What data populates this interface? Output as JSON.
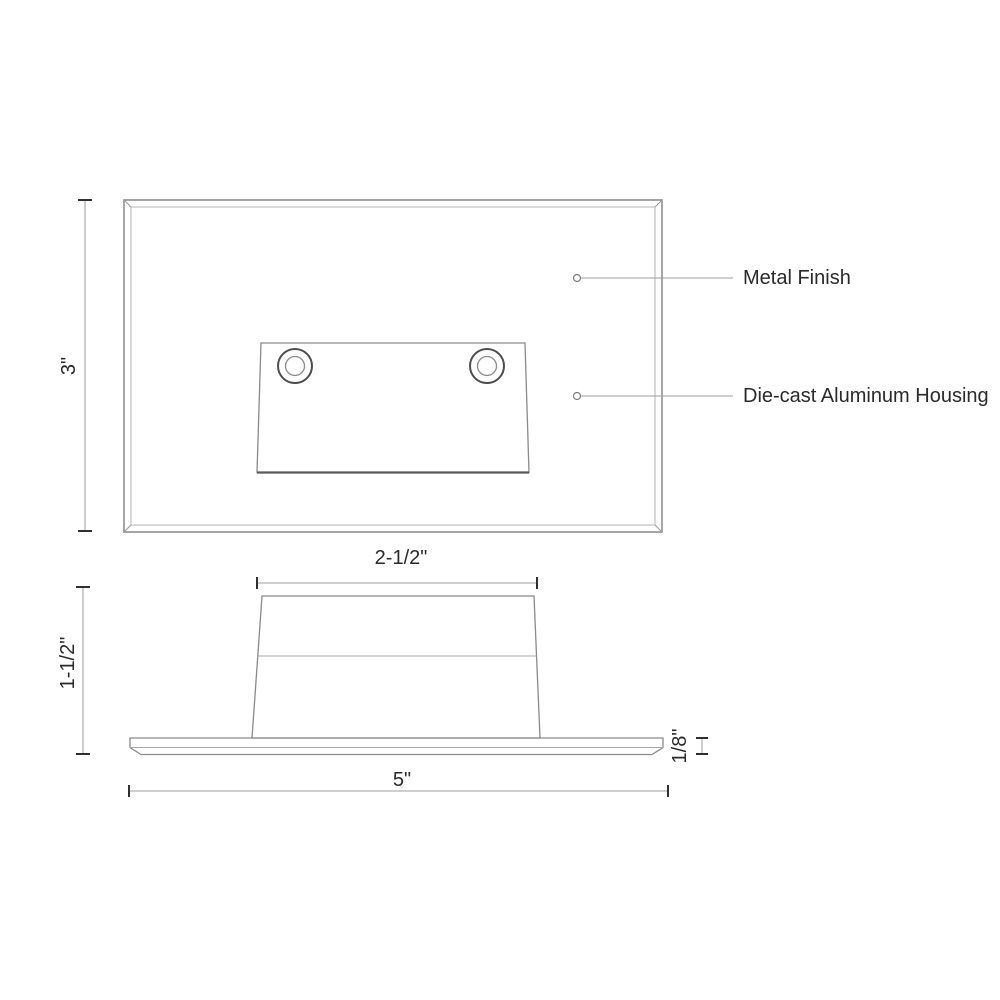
{
  "page": {
    "background": "#ffffff"
  },
  "palette": {
    "line_light": "#9c9c9c",
    "line_medium": "#8a8a8a",
    "line_dark": "#4e4e4e",
    "tick": "#2f2f2f",
    "text": "#2a2a2a"
  },
  "front_view": {
    "height_dim": "3\"",
    "callouts": [
      {
        "label": "Metal Finish"
      },
      {
        "label": "Die-cast Aluminum Housing"
      }
    ]
  },
  "side_view": {
    "top_width_dim": "2-1/2\"",
    "height_dim": "1-1/2\"",
    "plate_thickness_dim": "1/8\"",
    "overall_width_dim": "5\""
  }
}
